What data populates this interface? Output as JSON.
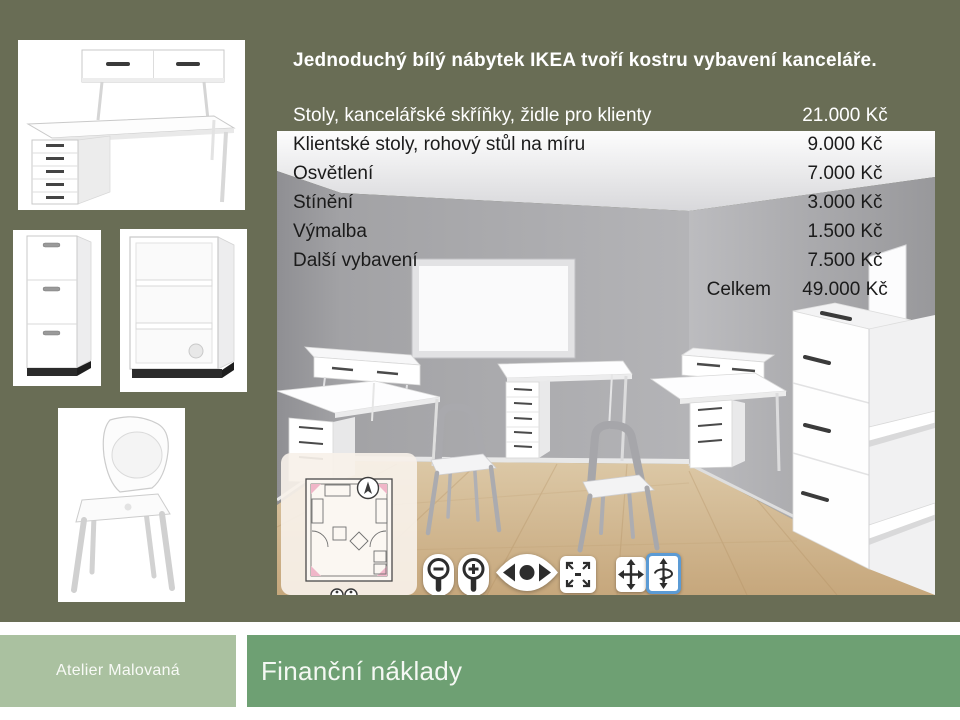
{
  "slide": {
    "intro": "Jednoduchý bílý nábytek IKEA tvoří kostru vybavení kanceláře.",
    "price_list": {
      "rows": [
        {
          "label": "Stoly, kancelářské skříňky, židle pro klienty",
          "price": "21.000 Kč"
        },
        {
          "label": "Klientské stoly, rohový stůl na míru",
          "price": "9.000 Kč"
        },
        {
          "label": "Osvětlení",
          "price": "7.000 Kč"
        },
        {
          "label": "Stínění",
          "price": "3.000 Kč"
        },
        {
          "label": "Výmalba",
          "price": "1.500 Kč"
        },
        {
          "label": "Další vybavení",
          "price": "7.500 Kč"
        }
      ],
      "total_label": "Celkem",
      "total_price": "49.000 Kč"
    },
    "footer": {
      "brand": "Atelier Malovaná",
      "slide_title": "Finanční náklady"
    },
    "images": {
      "desk_card": "ikea-white-desk-with-add-on-shelf",
      "cabinet_card": "ikea-white-file-cabinet",
      "shelf_card": "ikea-white-open-shelf-unit",
      "chair_card": "ikea-white-chair"
    },
    "planner": {
      "description": "ikea-home-planner-3d-office-preview",
      "selected_tool": "rotate",
      "tools": [
        "zoom-out",
        "zoom-in",
        "look-around",
        "fullscreen",
        "move",
        "rotate"
      ]
    },
    "colors": {
      "background": "#696d55",
      "brand_box": "#aac1a0",
      "title_box": "#6ea073",
      "selected_tool_border": "#5b9bd5"
    }
  }
}
